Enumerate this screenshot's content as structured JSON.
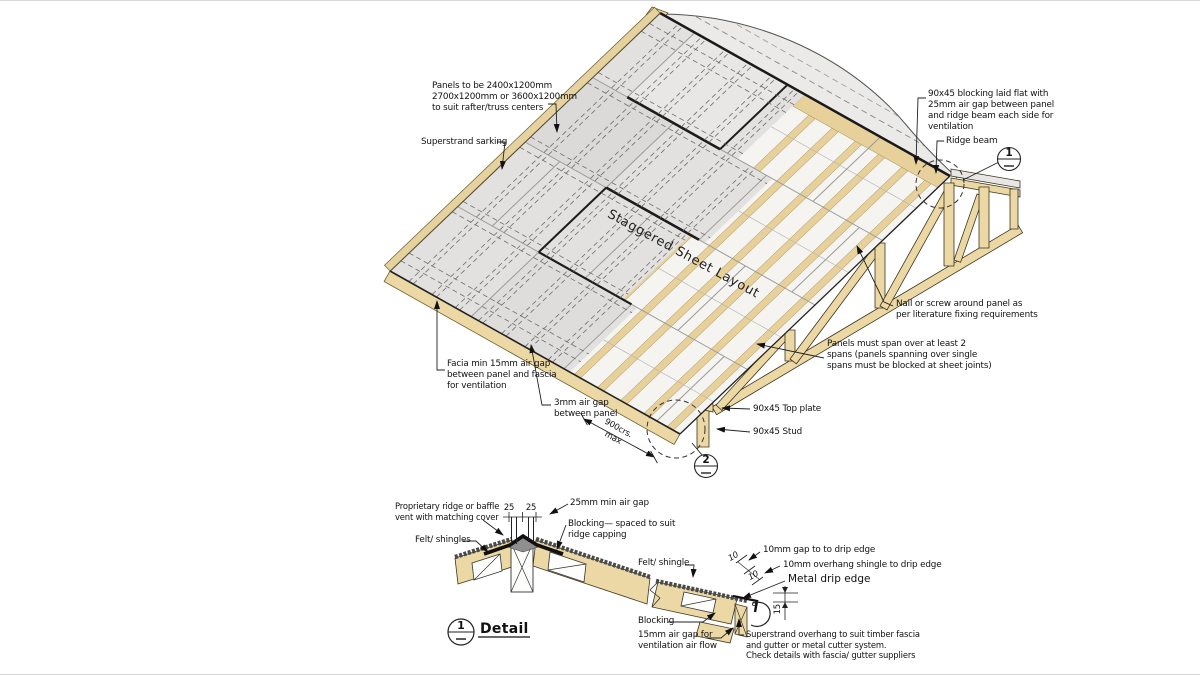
{
  "colors": {
    "wood": "#ecd8a4",
    "panel": "#e2e1df",
    "translucent": "#f5f4f1",
    "line": "#1a1a1a"
  },
  "iso": {
    "panels_spec": "Panels to be 2400x1200mm\n2700x1200mm or 3600x1200mm\nto suit rafter/truss centers",
    "sarking": "Superstrand sarking",
    "ridge_blocking": "90x45 blocking laid flat with\n25mm air gap between panel\nand ridge beam each side for\nventilation",
    "ridge_beam": "Ridge beam",
    "staggered": "Staggered Sheet Layout",
    "nail_screw": "Nail or screw around panel as\nper literature fixing requirements",
    "panel_span": "Panels must span over at least 2\nspans (panels spanning over single\nspans must be blocked at sheet joints)",
    "fascia_gap": "Facia min 15mm air gap\nbetween panel and fascia\nfor ventilation",
    "panel_gap": "3mm air gap\nbetween panel",
    "spacing": "900crs.\nmax",
    "top_plate": "90x45 Top plate",
    "stud": "90x45 Stud",
    "marker1": "1",
    "marker2": "2"
  },
  "ridge_detail": {
    "vent": "Proprietary ridge or baffle\nvent with matching cover",
    "dim_left": "25",
    "dim_right": "25",
    "air_gap": "25mm min air gap",
    "blocking": "Blocking— spaced to suit\nridge capping",
    "felt": "Felt/ shingles",
    "marker": "1",
    "title": "Detail"
  },
  "eave_detail": {
    "felt": "Felt/ shingle",
    "gap10": "10mm gap to to drip edge",
    "overhang10": "10mm overhang shingle to drip edge",
    "drip_edge": "Metal drip edge",
    "blocking": "Blocking",
    "airgap15": "15mm air gap for\nventilation air flow",
    "note": "Superstrand overhang to suit timber fascia\nand gutter or metal cutter system.\nCheck details with fascia/ gutter suppliers",
    "dim10a": "10",
    "dim10b": "10",
    "dim15": "15"
  }
}
